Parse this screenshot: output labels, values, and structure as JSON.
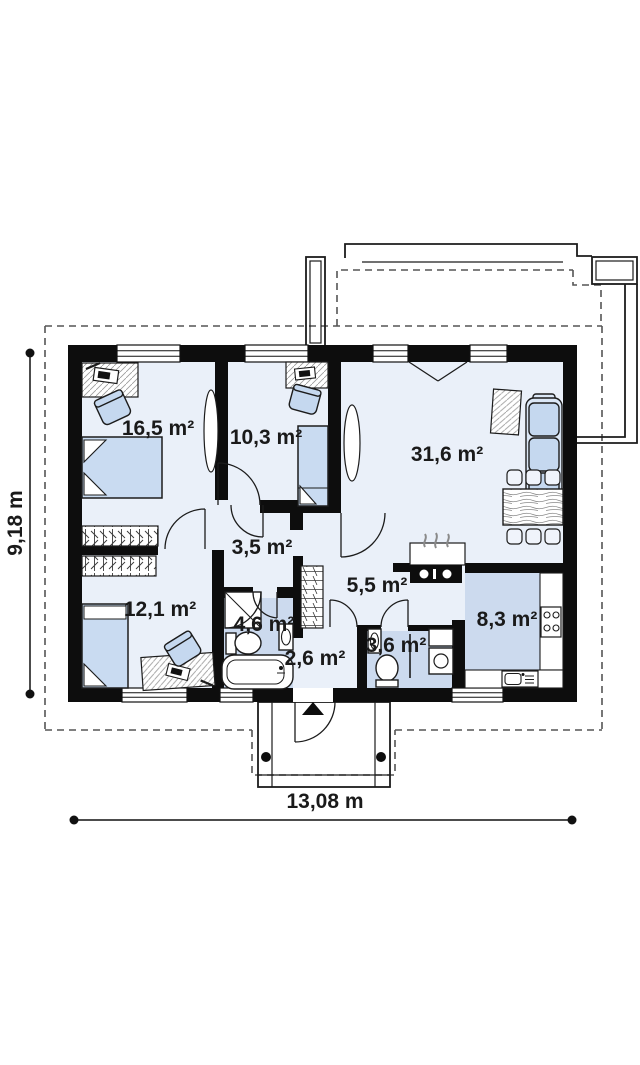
{
  "plan_title": "single-storey house floor plan",
  "rooms": [
    {
      "name": "bedroom-1",
      "label": "16,5 m²"
    },
    {
      "name": "bedroom-2",
      "label": "10,3 m²"
    },
    {
      "name": "living-room",
      "label": "31,6 m²"
    },
    {
      "name": "hall",
      "label": "3,5 m²"
    },
    {
      "name": "bedroom-3",
      "label": "12,1 m²"
    },
    {
      "name": "bathroom",
      "label": "4,6 m²"
    },
    {
      "name": "corridor",
      "label": "5,5 m²"
    },
    {
      "name": "entrance",
      "label": "2,6 m²"
    },
    {
      "name": "wc",
      "label": "3,6 m²"
    },
    {
      "name": "kitchen",
      "label": "8,3 m²"
    }
  ],
  "dimensions": {
    "width_label": "13,08 m",
    "height_label": "9,18 m"
  },
  "colors": {
    "wall": "#0d0d0d",
    "line": "#1a1a1a",
    "floor_light": "#eaf0f9",
    "floor_blue": "#ccdaee",
    "furniture_blue": "#c5d8ef",
    "dash": "#555555"
  }
}
